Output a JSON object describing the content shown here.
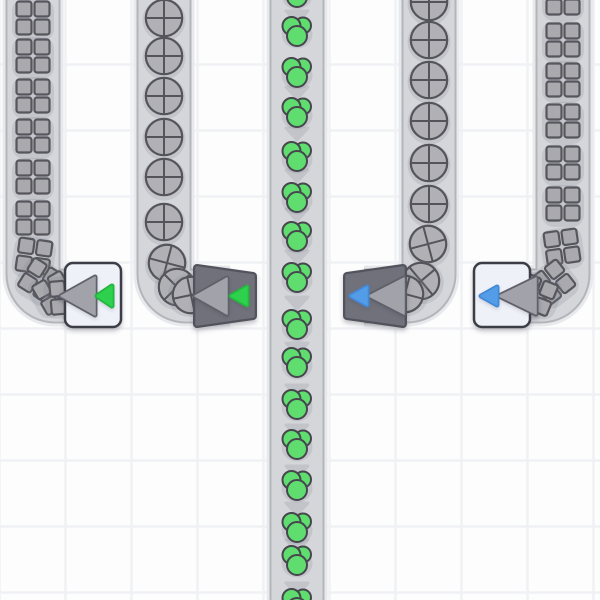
{
  "scene": {
    "name": "factory-conveyor-viewport",
    "width": 600,
    "height": 600
  },
  "colors": {
    "background": "#fdfdfe",
    "grid_line": "#f0f1f4",
    "belt_halo": "#e8e9ec",
    "belt_edge": "#b3b5ba",
    "belt_fill": "#d5d6da",
    "belt_arrow": "#c2c4c9",
    "item_halo": "rgba(130,136,150,0.22)",
    "square_fill": "#a9a9ae",
    "square_stroke": "#56565c",
    "circle_fill": "#b1b1b5",
    "circle_stroke": "#54545a",
    "green_fill": "#5fdd6e",
    "green_stroke": "#46464e",
    "dark_body": "#71717b",
    "dark_border": "#53535d",
    "light_body": "#eef1f8",
    "light_border": "#3e3e46",
    "tri_fill": "#a2a2aa",
    "tri_stroke": "#60606a",
    "green_tri": "#2dd14d",
    "green_tri_stroke": "#25b53f",
    "blue_tri": "#539ce8",
    "blue_tri_stroke": "#4288d4"
  },
  "grid": {
    "tile": 66,
    "first_x": -0.5,
    "first_y": -1.5,
    "line_width": 2.5
  },
  "belts": [
    {
      "name": "belt-left-outer",
      "item_type": "square",
      "path": "M33,-10L33,274A22,22 0 0 0 55,296L100,296",
      "items": [
        {
          "x": 33,
          "y": 18,
          "rot": 0
        },
        {
          "x": 33,
          "y": 56,
          "rot": 0
        },
        {
          "x": 33,
          "y": 96,
          "rot": 0
        },
        {
          "x": 33,
          "y": 136,
          "rot": 0
        },
        {
          "x": 33,
          "y": 177,
          "rot": 0
        },
        {
          "x": 33,
          "y": 218,
          "rot": 0
        },
        {
          "x": 34,
          "y": 256,
          "rot": 8
        },
        {
          "x": 40,
          "y": 280,
          "rot": 32
        },
        {
          "x": 54,
          "y": 293,
          "rot": 60
        },
        {
          "x": 67,
          "y": 297,
          "rot": 85
        }
      ],
      "arrows": []
    },
    {
      "name": "belt-left-inner",
      "item_type": "circle",
      "path": "M164,-10L164,274A22,22 0 0 0 186,296L230,296",
      "items": [
        {
          "x": 164,
          "y": 18,
          "rot": 0
        },
        {
          "x": 164,
          "y": 56,
          "rot": 0
        },
        {
          "x": 164,
          "y": 96,
          "rot": 0
        },
        {
          "x": 164,
          "y": 137,
          "rot": 0
        },
        {
          "x": 164,
          "y": 177,
          "rot": 0
        },
        {
          "x": 164,
          "y": 222,
          "rot": 0
        },
        {
          "x": 167,
          "y": 263,
          "rot": 15
        },
        {
          "x": 177,
          "y": 287,
          "rot": 45
        },
        {
          "x": 191,
          "y": 295,
          "rot": 78
        }
      ],
      "arrows": []
    },
    {
      "name": "belt-center",
      "item_type": "green-cluster",
      "path": "M297,-10L297,610",
      "items": [
        {
          "x": 297,
          "y": -8,
          "rot": 0
        },
        {
          "x": 297,
          "y": 31,
          "rot": 0
        },
        {
          "x": 297,
          "y": 72,
          "rot": 0
        },
        {
          "x": 297,
          "y": 112,
          "rot": 0
        },
        {
          "x": 297,
          "y": 156,
          "rot": 0
        },
        {
          "x": 297,
          "y": 197,
          "rot": 0
        },
        {
          "x": 297,
          "y": 236,
          "rot": 0
        },
        {
          "x": 297,
          "y": 277,
          "rot": 0
        },
        {
          "x": 297,
          "y": 324,
          "rot": 0
        },
        {
          "x": 297,
          "y": 362,
          "rot": 0
        },
        {
          "x": 297,
          "y": 404,
          "rot": 0
        },
        {
          "x": 297,
          "y": 444,
          "rot": 0
        },
        {
          "x": 297,
          "y": 485,
          "rot": 0
        },
        {
          "x": 297,
          "y": 527,
          "rot": 0
        },
        {
          "x": 297,
          "y": 560,
          "rot": 0
        },
        {
          "x": 297,
          "y": 603,
          "rot": 0
        }
      ],
      "arrows": [
        16,
        92,
        133,
        175,
        214,
        256,
        302,
        348,
        390,
        430,
        471,
        508,
        545,
        588
      ]
    },
    {
      "name": "belt-right-inner",
      "item_type": "circle",
      "path": "M429,-10L429,274A22,22 0 0 1 407,296L364,296",
      "items": [
        {
          "x": 429,
          "y": 2,
          "rot": 0
        },
        {
          "x": 429,
          "y": 40,
          "rot": 0
        },
        {
          "x": 429,
          "y": 80,
          "rot": 0
        },
        {
          "x": 429,
          "y": 121,
          "rot": 0
        },
        {
          "x": 429,
          "y": 163,
          "rot": 0
        },
        {
          "x": 429,
          "y": 204,
          "rot": 0
        },
        {
          "x": 428,
          "y": 244,
          "rot": -15
        },
        {
          "x": 421,
          "y": 281,
          "rot": -40
        },
        {
          "x": 405,
          "y": 294,
          "rot": -75
        }
      ],
      "arrows": []
    },
    {
      "name": "belt-right-outer",
      "item_type": "square",
      "path": "M563,-10L563,274A22,22 0 0 1 541,296L496,296",
      "items": [
        {
          "x": 563,
          "y": -2,
          "rot": 0
        },
        {
          "x": 563,
          "y": 40,
          "rot": 0
        },
        {
          "x": 563,
          "y": 80,
          "rot": 0
        },
        {
          "x": 563,
          "y": 121,
          "rot": 0
        },
        {
          "x": 563,
          "y": 163,
          "rot": 0
        },
        {
          "x": 563,
          "y": 204,
          "rot": 0
        },
        {
          "x": 562,
          "y": 247,
          "rot": -8
        },
        {
          "x": 553,
          "y": 282,
          "rot": -38
        },
        {
          "x": 537,
          "y": 295,
          "rot": -68
        }
      ],
      "arrows": []
    }
  ],
  "buildings": [
    {
      "name": "tunnel-left-outer",
      "body": "light-rect",
      "rect": {
        "x": 65,
        "y": 263,
        "w": 56,
        "h": 64,
        "rx": 8
      },
      "big_arrow": {
        "apex_x": 61,
        "base_x": 95,
        "y1": 277,
        "y2": 315
      },
      "small_arrow": {
        "color": "green",
        "apex_x": 97,
        "base_x": 112,
        "y1": 286,
        "y2": 306
      }
    },
    {
      "name": "tunnel-left-inner",
      "body": "dark-trapezoid",
      "points": [
        [
          197,
          268
        ],
        [
          253,
          276
        ],
        [
          253,
          316
        ],
        [
          197,
          324
        ]
      ],
      "big_arrow": {
        "apex_x": 195,
        "base_x": 227,
        "y1": 278,
        "y2": 314
      },
      "small_arrow": {
        "color": "green",
        "apex_x": 231,
        "base_x": 247,
        "y1": 287,
        "y2": 305
      }
    },
    {
      "name": "tunnel-right-inner",
      "body": "dark-trapezoid",
      "points": [
        [
          347,
          276
        ],
        [
          403,
          268
        ],
        [
          403,
          324
        ],
        [
          347,
          316
        ]
      ],
      "big_arrow": {
        "apex_x": 369,
        "base_x": 404,
        "y1": 278,
        "y2": 314
      },
      "small_arrow": {
        "color": "blue",
        "apex_x": 351,
        "base_x": 367,
        "y1": 287,
        "y2": 305
      }
    },
    {
      "name": "tunnel-right-outer",
      "body": "light-rect",
      "rect": {
        "x": 474,
        "y": 263,
        "w": 56,
        "h": 64,
        "rx": 8
      },
      "big_arrow": {
        "apex_x": 499,
        "base_x": 536,
        "y1": 278,
        "y2": 314
      },
      "small_arrow": {
        "color": "blue",
        "apex_x": 481,
        "base_x": 497,
        "y1": 287,
        "y2": 305
      }
    }
  ]
}
